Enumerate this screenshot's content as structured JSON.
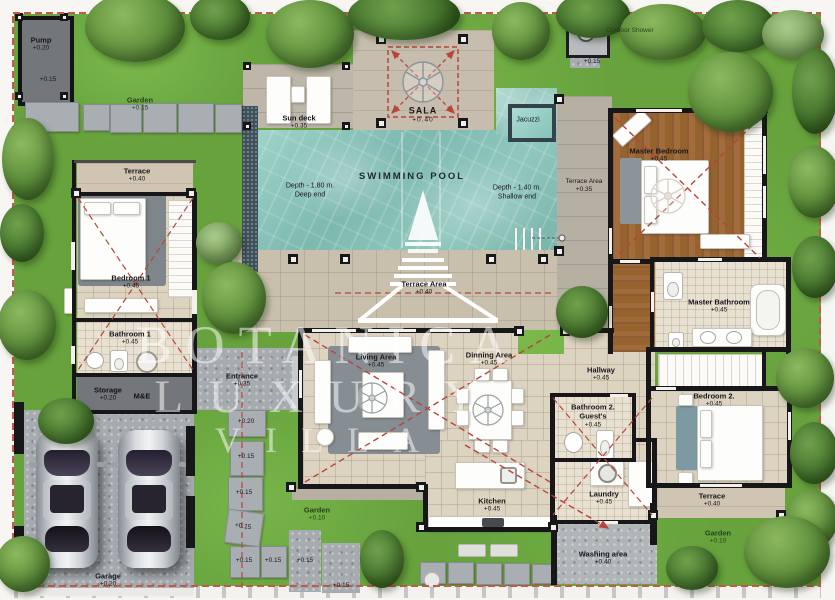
{
  "plan": {
    "watermark": [
      "BOTANICA",
      "LUXURY",
      "VILLA"
    ],
    "pool": {
      "title": "SWIMMING POOL",
      "deep_depth": "Depth - 1.80 m.",
      "deep_label": "Deep end",
      "shallow_depth": "Depth - 1.40 m.",
      "shallow_label": "Shallow end",
      "jacuzzi": "Jacuzzi"
    },
    "rooms": {
      "pump": {
        "name": "Pump",
        "elev": "+0.20",
        "elev2": "+0.15"
      },
      "garden_top": {
        "name": "Garden",
        "elev": "+0.15"
      },
      "outdoor_shower": {
        "name": "Outdoor Shower",
        "elev": "+0.15"
      },
      "sun_deck": {
        "name": "Sun deck",
        "elev": "+0.35"
      },
      "sala": {
        "name": "SALA",
        "elev": "+0.40"
      },
      "terrace_pool": {
        "name": "Terrace Area",
        "elev": "+0.40"
      },
      "terrace_master": {
        "name": "Terrace Area",
        "elev": "+0.35"
      },
      "master_bedroom": {
        "name": "Master Bedroom",
        "elev": "+0.45"
      },
      "master_bathroom": {
        "name": "Master Bathroom",
        "elev": "+0.45"
      },
      "terrace_b1": {
        "name": "Terrace",
        "elev": "+0.40"
      },
      "bedroom1": {
        "name": "Bedroom 1",
        "elev": "+0.45"
      },
      "bathroom1": {
        "name": "Bathroom 1",
        "elev": "+0.45"
      },
      "storage": {
        "name": "Storage",
        "elev": "+0.20"
      },
      "me": {
        "name": "M&E"
      },
      "entrance": {
        "name": "Entrance",
        "elev": "+0.35"
      },
      "living": {
        "name": "Living Area",
        "elev": "+0.45"
      },
      "dining": {
        "name": "Dinning Area",
        "elev": "+0.45"
      },
      "hallway": {
        "name": "Hallway",
        "elev": "+0.45"
      },
      "bathroom2": {
        "name": "Bathroom 2.",
        "sub": "Guest's",
        "elev": "+0.45"
      },
      "bedroom2": {
        "name": "Bedroom 2.",
        "elev": "+0.45"
      },
      "terrace_b2": {
        "name": "Terrace",
        "elev": "+0.40"
      },
      "kitchen": {
        "name": "Kitchen",
        "elev": "+0.45"
      },
      "laundry": {
        "name": "Laundry",
        "elev": "+0.45"
      },
      "washing": {
        "name": "Washing area",
        "elev": "+0.40"
      },
      "garden_bottom": {
        "name": "Garden",
        "elev": "+0.10"
      },
      "garden_right": {
        "name": "Garden",
        "elev": "+0.10"
      },
      "garage": {
        "name": "Garage",
        "elev": "+0.20"
      }
    },
    "stones": {
      "s1": "+0.20",
      "s2": "+0.15",
      "s3": "+0.15",
      "s4": "+0.15",
      "s5": "+0.15",
      "s6": "+0.15",
      "s7": "+0.15",
      "s8": "+0.15"
    },
    "colors": {
      "grass": "#67a23d",
      "water": "#8fc7bd",
      "deck": "#c9bfad",
      "wall": "#17171a",
      "boundary_dash": "#c4584b",
      "roof_dash": "#b8443a"
    }
  }
}
